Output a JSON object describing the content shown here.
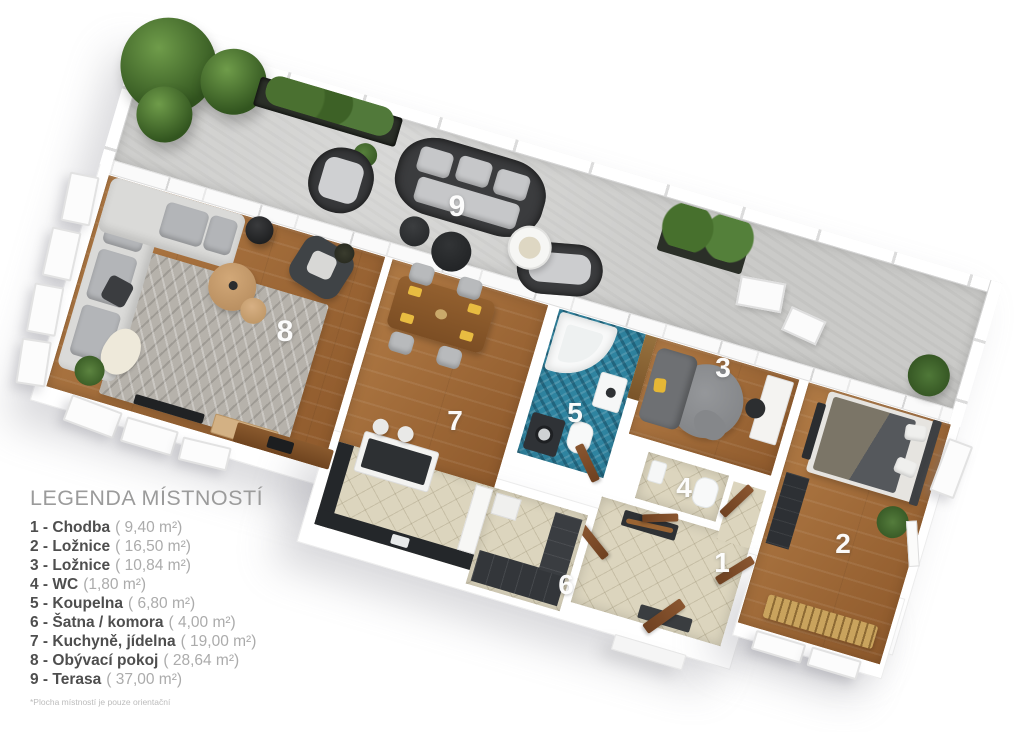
{
  "legend": {
    "title": "LEGENDA MÍSTNOSTÍ",
    "items": [
      {
        "label": "1 - Chodba",
        "area": "( 9,40 m²)"
      },
      {
        "label": "2 - Ložnice",
        "area": "( 16,50 m²)"
      },
      {
        "label": "3 - Ložnice",
        "area": "( 10,84 m²)"
      },
      {
        "label": "4 - WC",
        "area": "(1,80 m²)"
      },
      {
        "label": "5 - Koupelna",
        "area": "( 6,80 m²)"
      },
      {
        "label": "6 - Šatna / komora",
        "area": "( 4,00 m²)"
      },
      {
        "label": "7 - Kuchyně, jídelna",
        "area": "( 19,00 m²)"
      },
      {
        "label": "8 - Obývací pokoj",
        "area": "( 28,64 m²)"
      },
      {
        "label": "9 - Terasa",
        "area": "( 37,00 m²)"
      }
    ],
    "footnote": "*Plocha místností je pouze orientační"
  },
  "plan": {
    "rooms": [
      {
        "id": "chodba",
        "num": "1"
      },
      {
        "id": "loznice-2",
        "num": "2"
      },
      {
        "id": "loznice-3",
        "num": "3"
      },
      {
        "id": "wc",
        "num": "4"
      },
      {
        "id": "koupelna",
        "num": "5"
      },
      {
        "id": "satna-komora",
        "num": "6"
      },
      {
        "id": "kuchyne-jidelna",
        "num": "7"
      },
      {
        "id": "obyvaci-pokoj",
        "num": "8"
      },
      {
        "id": "terasa",
        "num": "9"
      }
    ],
    "colors": {
      "wood_floor": "#a06837",
      "terrace_concrete": "#cacac8",
      "tile_beige": "#dcd5be",
      "bath_mosaic": "#2f84a0",
      "accent_yellow": "#e5b735",
      "furniture_dark": "#35383b",
      "sofa_light": "#dadad8",
      "plant_green": "#4f7838",
      "door_brown": "#7b4a2a",
      "label_white": "#ffffff"
    }
  }
}
